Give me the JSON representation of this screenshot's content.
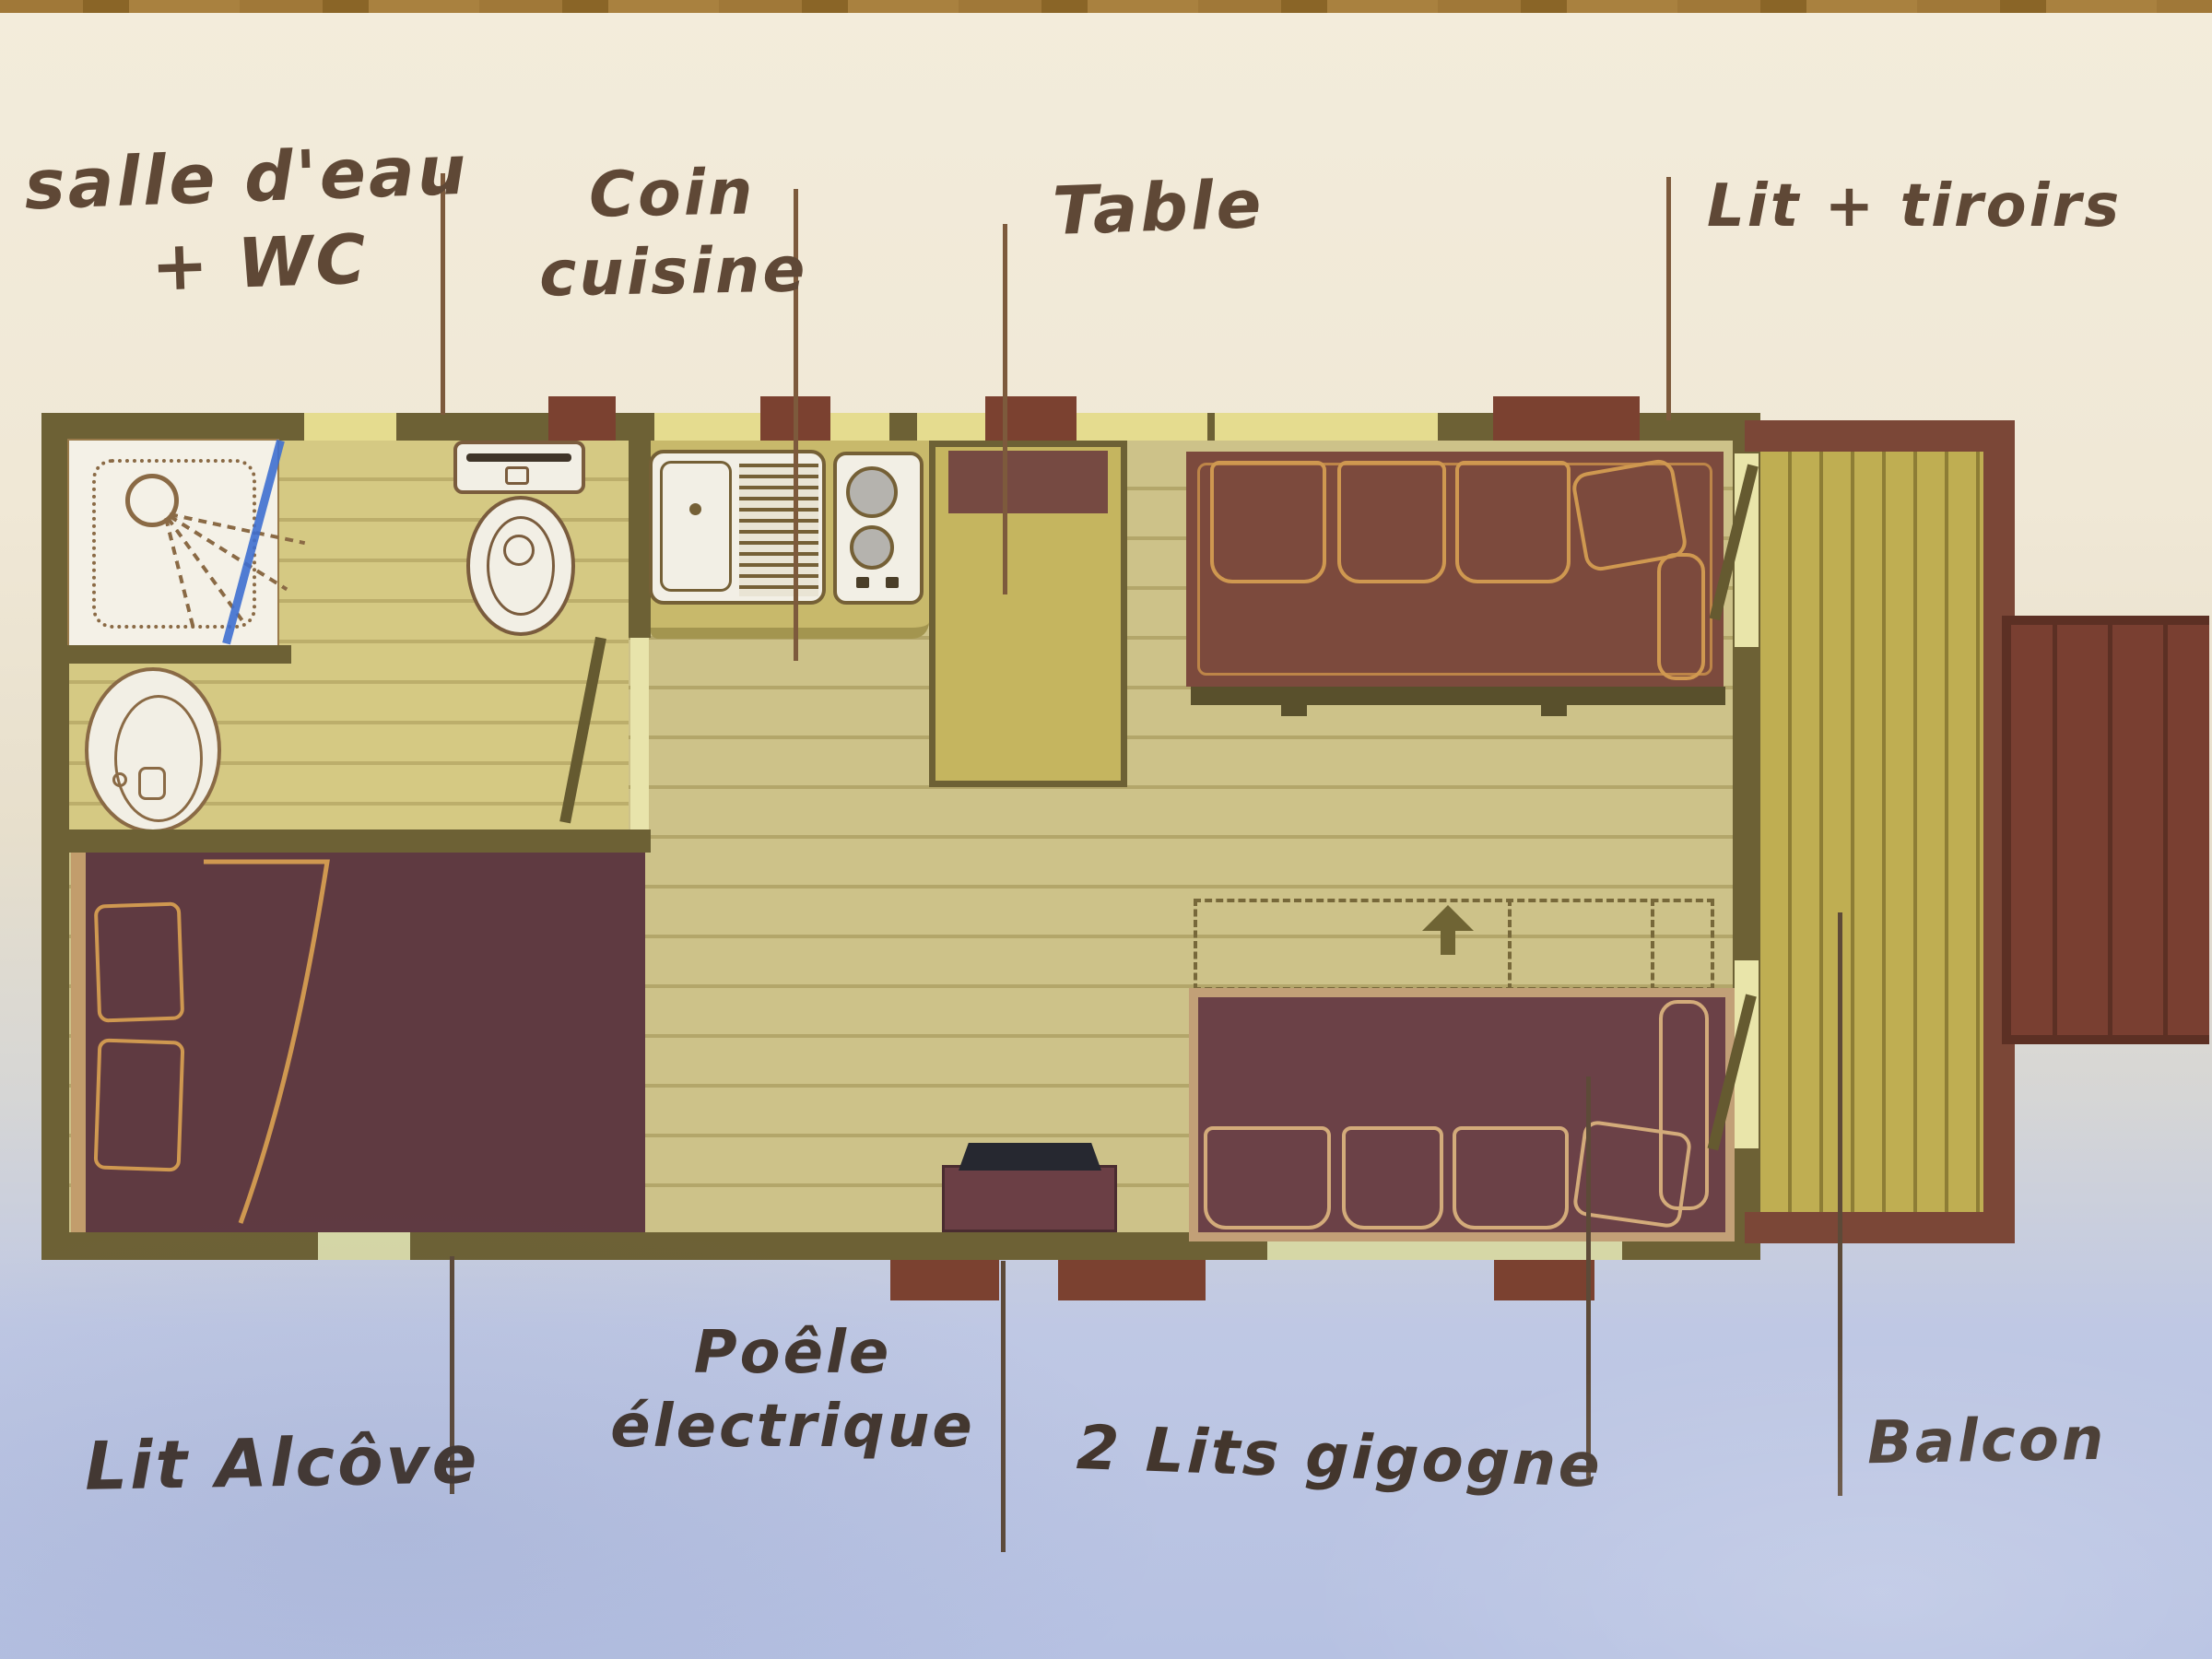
{
  "document": {
    "kind": "photographed hand-annotated floor plan of a small cabin / gypsy-caravan rental",
    "language": "French"
  },
  "annotations": {
    "salle_deau_wc": {
      "line1": "salle d'eau",
      "line2": "+ WC"
    },
    "coin_cuisine": {
      "line1": "Coin",
      "line2": "cuisine"
    },
    "table": {
      "label": "Table"
    },
    "lit_tiroirs": {
      "label": "Lit + tiroirs"
    },
    "lit_alcove": {
      "label": "Lit Alcôve"
    },
    "poele_electrique": {
      "line1": "Poêle",
      "line2": "électrique"
    },
    "lits_gigogne": {
      "label": "2 Lits gigogne"
    },
    "balcon": {
      "label": "Balcon"
    }
  },
  "plan": {
    "rooms": [
      "bathroom with shower, washbasin and WC",
      "kitchen corner",
      "living area",
      "alcove bed corner",
      "balcony with stairs"
    ],
    "fixtures": [
      "shower-symbol",
      "washbasin-symbol",
      "toilet-symbol",
      "kitchen-sink-symbol",
      "hob-symbol",
      "table-symbol",
      "sofa-bed-with-drawers",
      "two-pull-out-beds-dashed",
      "electric-stove-symbol",
      "alcove-double-bed",
      "balcony-deck",
      "exterior-stairs"
    ],
    "notes": "blue ballpoint stroke drawn across the bathroom; dashed rectangle with up arrow shows pull-out position of the two gigogne beds"
  },
  "colors": {
    "paper_top": "#f3ecdb",
    "paper_bottom_blue": "#b6c1e2",
    "wood_table_edge": "#a07838",
    "wall_olive": "#6d6135",
    "floor_khaki": "#cdc289",
    "plank_line": "#b3a66a",
    "window_gap": "#e5dc8f",
    "furniture_maroon": "#7c4a3d",
    "bed_maroon": "#5f3a41",
    "gold_outline": "#cf9850",
    "railing_maroon": "#7b4737",
    "appliance_white": "#f2efe5",
    "pen_blue": "#3e6fd0",
    "ink_brown": "#5f4836"
  }
}
